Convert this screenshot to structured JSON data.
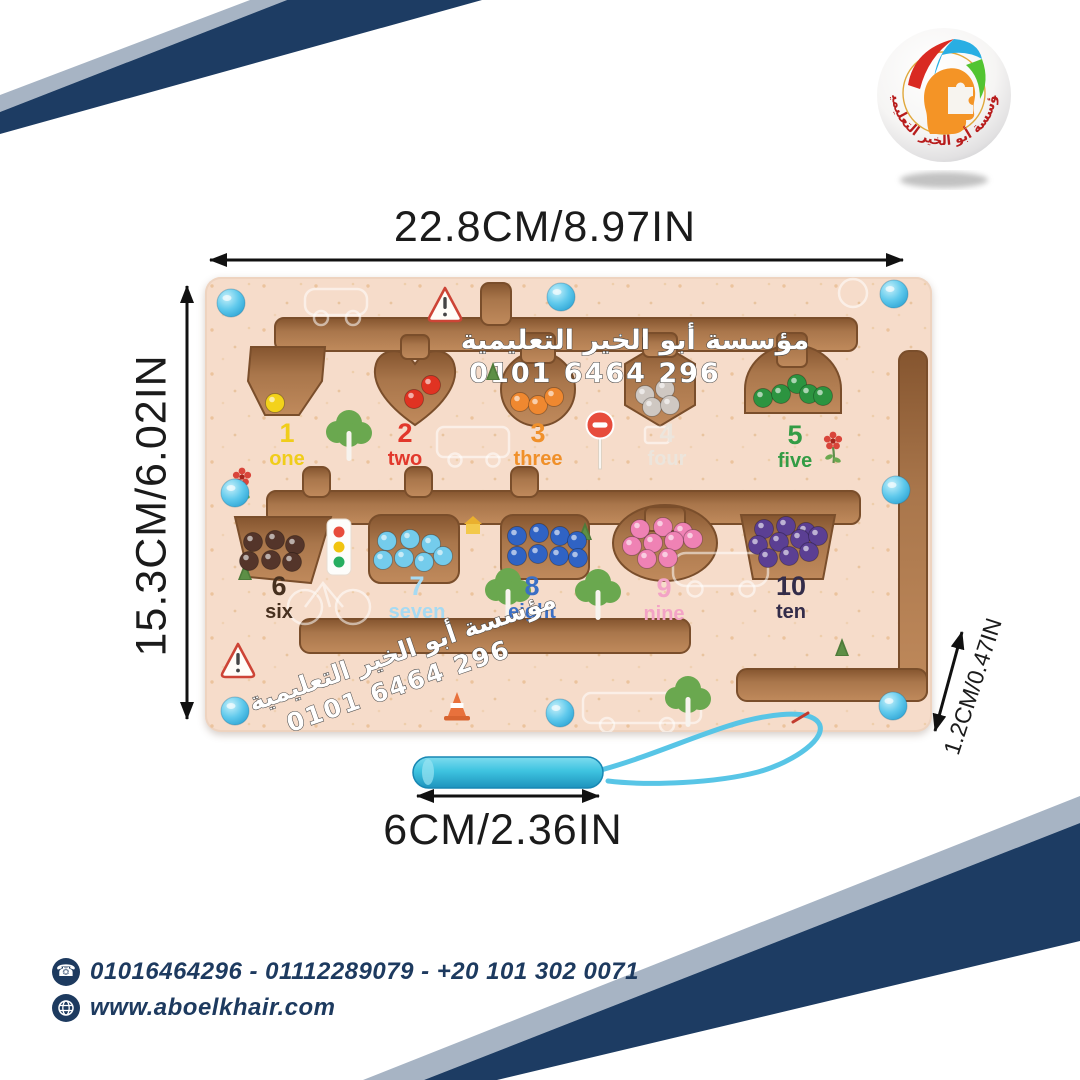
{
  "logo": {
    "arc_text": "مؤسسة أبو الخير التعليمية"
  },
  "watermark": {
    "line1": "مؤسسة أبو الخير التعليمية",
    "line2": "0101 6464 296"
  },
  "annotations": {
    "top_width": "22.8CM/8.97IN",
    "left_height": "15.3CM/6.02IN",
    "right_thickness": "1.2CM/0.47IN",
    "pen_length": "6CM/2.36IN"
  },
  "board": {
    "numbers": [
      {
        "value": "1",
        "word": "one",
        "label_color": "#f0cd1a",
        "bead_color": "#f3d21b",
        "bead_count": 1
      },
      {
        "value": "2",
        "word": "two",
        "label_color": "#e2382c",
        "bead_color": "#e03322",
        "bead_count": 2
      },
      {
        "value": "3",
        "word": "three",
        "label_color": "#f0902a",
        "bead_color": "#ef8830",
        "bead_count": 3
      },
      {
        "value": "4",
        "word": "four",
        "label_color": "#ece5dc",
        "bead_color": "#cfc8c2",
        "bead_count": 4
      },
      {
        "value": "5",
        "word": "five",
        "label_color": "#339c45",
        "bead_color": "#2c9440",
        "bead_count": 5
      },
      {
        "value": "6",
        "word": "six",
        "label_color": "#47301f",
        "bead_color": "#54352a",
        "bead_count": 6
      },
      {
        "value": "7",
        "word": "seven",
        "label_color": "#a6daf2",
        "bead_color": "#74ccec",
        "bead_count": 7
      },
      {
        "value": "8",
        "word": "eight",
        "label_color": "#3a6fc5",
        "bead_color": "#3063c4",
        "bead_count": 8
      },
      {
        "value": "9",
        "word": "nine",
        "label_color": "#f3a3c6",
        "bead_color": "#ef82b4",
        "bead_count": 9
      },
      {
        "value": "10",
        "word": "ten",
        "label_color": "#332c49",
        "bead_color": "#5b3f93",
        "bead_count": 10
      }
    ]
  },
  "contact": {
    "phones": "01016464296 - 01112289079 - +20 101 302 0071",
    "website": "www.aboelkhair.com"
  },
  "colors": {
    "navy_band": "#1d3c63",
    "gray_band": "#a7b4c4",
    "board_wood": "#f6dcca",
    "channel_wood": "#a9764b",
    "peg_blue": "#4fc0e8",
    "pen_blue": "#3ec3e0",
    "contact_navy": "#1d3a5f",
    "logo_red": "#d92a22",
    "logo_orange": "#f49426"
  }
}
